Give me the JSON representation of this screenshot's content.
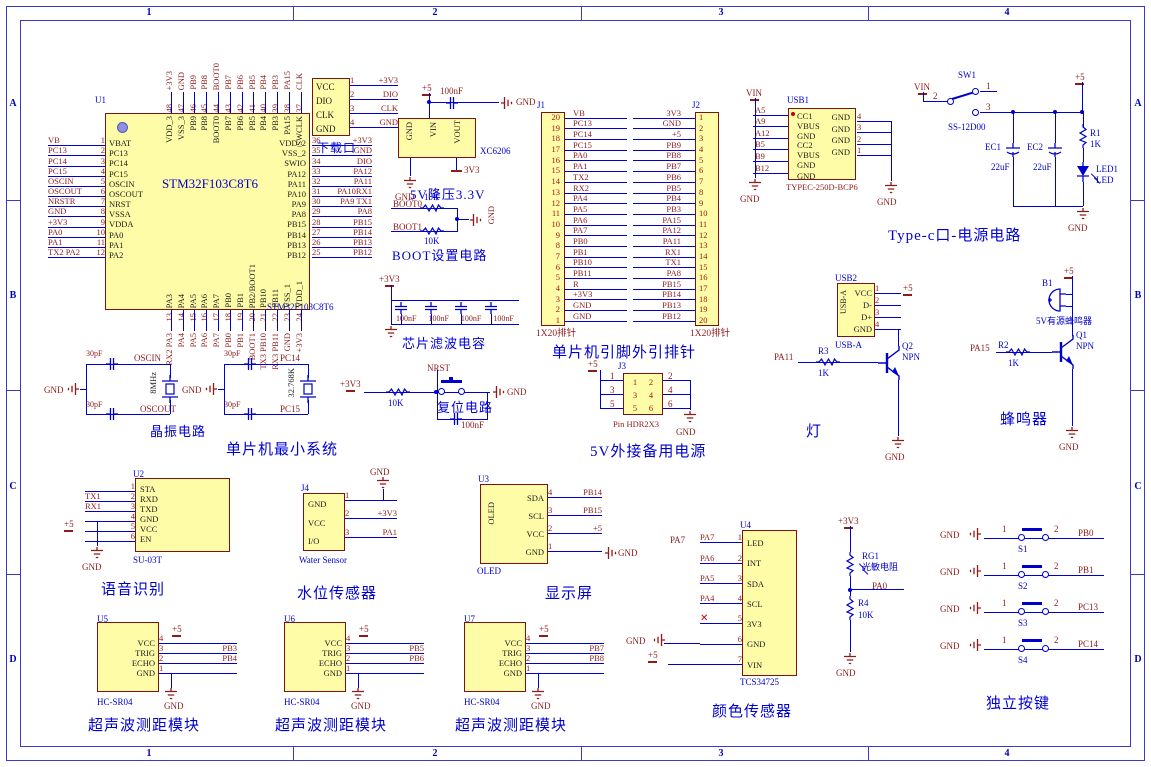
{
  "frame": {
    "cols": [
      "1",
      "2",
      "3",
      "4"
    ],
    "rows": [
      "A",
      "B",
      "C",
      "D"
    ]
  },
  "colors": {
    "wire": "#0000cd",
    "fill": "#fffca8",
    "border": "#7d1414",
    "net": "#8e1a1a"
  },
  "mcu": {
    "ref": "U1",
    "name": "STM32F103C8T6",
    "footer": "STM32F103C8T6",
    "left_pins": [
      {
        "net": "VB",
        "num": "1",
        "name": "VBAT"
      },
      {
        "net": "PC13",
        "num": "2",
        "name": "PC13"
      },
      {
        "net": "PC14",
        "num": "3",
        "name": "PC14"
      },
      {
        "net": "PC15",
        "num": "4",
        "name": "PC15"
      },
      {
        "net": "OSCIN",
        "num": "5",
        "name": "OSCIN"
      },
      {
        "net": "OSCOUT",
        "num": "6",
        "name": "OSCOUT"
      },
      {
        "net": "NRSTR",
        "num": "7",
        "name": "NRST"
      },
      {
        "net": "GND",
        "num": "8",
        "name": "VSSA"
      },
      {
        "net": "+3V3",
        "num": "9",
        "name": "VDDA"
      },
      {
        "net": "PA0",
        "num": "10",
        "name": "PA0"
      },
      {
        "net": "PA1",
        "num": "11",
        "name": "PA1"
      },
      {
        "net": "TX2 PA2",
        "num": "12",
        "name": "PA2"
      }
    ],
    "right_pins": [
      {
        "num": "36",
        "net": "+3V3",
        "name": "VDD_2"
      },
      {
        "num": "35",
        "net": "GND",
        "name": "VSS_2"
      },
      {
        "num": "34",
        "net": "DIO",
        "name": "SWIO"
      },
      {
        "num": "33",
        "net": "PA12",
        "name": "PA12"
      },
      {
        "num": "32",
        "net": "PA11",
        "name": "PA11"
      },
      {
        "num": "31",
        "net": "PA10RX1",
        "name": "PA10"
      },
      {
        "num": "30",
        "net": "PA9 TX1",
        "name": "PA9"
      },
      {
        "num": "29",
        "net": "PA8",
        "name": "PA8"
      },
      {
        "num": "28",
        "net": "PB15",
        "name": "PB15"
      },
      {
        "num": "27",
        "net": "PB14",
        "name": "PB14"
      },
      {
        "num": "26",
        "net": "PB13",
        "name": "PB13"
      },
      {
        "num": "25",
        "net": "PB12",
        "name": "PB12"
      }
    ],
    "top_pins": [
      {
        "num": "48",
        "net": "+3V3",
        "name": "VDD_3"
      },
      {
        "num": "47",
        "net": "GND",
        "name": "VSS_3"
      },
      {
        "num": "46",
        "net": "PB9",
        "name": "PB9"
      },
      {
        "num": "45",
        "net": "PB8",
        "name": "PB8"
      },
      {
        "num": "44",
        "net": "BOOT0",
        "name": "BOOT0"
      },
      {
        "num": "43",
        "net": "PB7",
        "name": "PB7"
      },
      {
        "num": "42",
        "net": "PB6",
        "name": "PB6"
      },
      {
        "num": "41",
        "net": "PB5",
        "name": "PB5"
      },
      {
        "num": "40",
        "net": "PB4",
        "name": "PB4"
      },
      {
        "num": "39",
        "net": "PB3",
        "name": "PB3"
      },
      {
        "num": "38",
        "net": "PA15",
        "name": "PA15"
      },
      {
        "num": "37",
        "net": "CLK",
        "name": "SWCLK"
      }
    ],
    "bottom_pins": [
      {
        "num": "13",
        "net": "RX2 PA3",
        "name": "PA3"
      },
      {
        "num": "14",
        "net": "PA4",
        "name": "PA4"
      },
      {
        "num": "15",
        "net": "PA5",
        "name": "PA5"
      },
      {
        "num": "16",
        "net": "PA6",
        "name": "PA6"
      },
      {
        "num": "17",
        "net": "PA7",
        "name": "PA7"
      },
      {
        "num": "18",
        "net": "PB0",
        "name": "PB0"
      },
      {
        "num": "19",
        "net": "PB1",
        "name": "PB1"
      },
      {
        "num": "20",
        "net": "BOOT1",
        "name": "PB2/BOOT1"
      },
      {
        "num": "21",
        "net": "TX3 PB10",
        "name": "PB10"
      },
      {
        "num": "22",
        "net": "RX3 PB11",
        "name": "PB11"
      },
      {
        "num": "23",
        "net": "GND",
        "name": "VSS_1"
      },
      {
        "num": "24",
        "net": "+3V3",
        "name": "VDD_1"
      }
    ]
  },
  "download": {
    "caption": "下载口",
    "pins": [
      {
        "name": "VCC",
        "num": "1",
        "net": "+3V3"
      },
      {
        "name": "DIO",
        "num": "2",
        "net": "DIO"
      },
      {
        "name": "CLK",
        "num": "3",
        "net": "CLK"
      },
      {
        "name": "GND",
        "num": "4",
        "net": "GND"
      }
    ]
  },
  "regulator": {
    "part": "XC6206",
    "caption": "5V降压3.3V",
    "pin_gnd": "GND",
    "pin_vin": "VIN",
    "pin_vout": "VOUT",
    "rail_in": "+5",
    "cap": "100nF",
    "gnd_top": "GND",
    "gnd_bottom": "GND",
    "rail_out": "3V3"
  },
  "boot": {
    "caption": "BOOT设置电路",
    "net0": "BOOT0",
    "net1": "BOOT1",
    "r0": "10K",
    "r1": "10K",
    "gnd": "GND"
  },
  "filter": {
    "caption": "芯片滤波电容",
    "rail": "+3V3",
    "caps": [
      "100nF",
      "100nF",
      "100nF",
      "100nF"
    ]
  },
  "headers": {
    "caption": "单片机引脚外引排针",
    "j1": {
      "ref": "J1",
      "part": "1X20排针",
      "pins": [
        {
          "num": "20",
          "net": "VB"
        },
        {
          "num": "19",
          "net": "PC13"
        },
        {
          "num": "18",
          "net": "PC14"
        },
        {
          "num": "17",
          "net": "PC15"
        },
        {
          "num": "16",
          "net": "PA0"
        },
        {
          "num": "15",
          "net": "PA1"
        },
        {
          "num": "14",
          "net": "TX2"
        },
        {
          "num": "13",
          "net": "RX2"
        },
        {
          "num": "12",
          "net": "PA4"
        },
        {
          "num": "11",
          "net": "PA5"
        },
        {
          "num": "10",
          "net": "PA6"
        },
        {
          "num": "9",
          "net": "PA7"
        },
        {
          "num": "8",
          "net": "PB0"
        },
        {
          "num": "7",
          "net": "PB1"
        },
        {
          "num": "6",
          "net": "PB10"
        },
        {
          "num": "5",
          "net": "PB11"
        },
        {
          "num": "4",
          "net": "R"
        },
        {
          "num": "3",
          "net": "+3V3"
        },
        {
          "num": "2",
          "net": "GND"
        },
        {
          "num": "1",
          "net": "GND"
        }
      ]
    },
    "j2": {
      "ref": "J2",
      "part": "1X20排针",
      "pins": [
        {
          "num": "1",
          "net": "3V3"
        },
        {
          "num": "2",
          "net": "GND"
        },
        {
          "num": "3",
          "net": "+5"
        },
        {
          "num": "4",
          "net": "PB9"
        },
        {
          "num": "5",
          "net": "PB8"
        },
        {
          "num": "6",
          "net": "PB7"
        },
        {
          "num": "7",
          "net": "PB6"
        },
        {
          "num": "8",
          "net": "PB5"
        },
        {
          "num": "9",
          "net": "PB4"
        },
        {
          "num": "10",
          "net": "PB3"
        },
        {
          "num": "11",
          "net": "PA15"
        },
        {
          "num": "12",
          "net": "PA12"
        },
        {
          "num": "13",
          "net": "PA11"
        },
        {
          "num": "14",
          "net": "RX1"
        },
        {
          "num": "15",
          "net": "TX1"
        },
        {
          "num": "16",
          "net": "PA8"
        },
        {
          "num": "17",
          "net": "PB15"
        },
        {
          "num": "18",
          "net": "PB14"
        },
        {
          "num": "19",
          "net": "PB13"
        },
        {
          "num": "20",
          "net": "PB12"
        }
      ]
    }
  },
  "usb1": {
    "ref": "USB1",
    "part": "TYPEC-250D-BCP6",
    "vin": "VIN",
    "gnd_left": "GND",
    "gnd_right": "GND",
    "extra_name": "GND",
    "left_rows": [
      {
        "net": "A5",
        "name": "CC1"
      },
      {
        "net": "A9",
        "name": "VBUS"
      },
      {
        "net": "A12",
        "name": "GND"
      },
      {
        "net": "B5",
        "name": "CC2"
      },
      {
        "net": "B9",
        "name": "VBUS"
      },
      {
        "net": "B12",
        "name": "GND"
      }
    ],
    "right_rows": [
      {
        "name": "GND",
        "num": "4"
      },
      {
        "name": "GND",
        "num": "3"
      },
      {
        "name": "GND",
        "num": "2"
      },
      {
        "name": "GND",
        "num": "1"
      }
    ]
  },
  "power": {
    "caption": "Type-c口-电源电路",
    "vin": "VIN",
    "sw": "SW1",
    "sw_part": "SS-12D00",
    "p1": "1",
    "p2": "2",
    "p3": "3",
    "rail": "+5",
    "ec1": "EC1",
    "ec1v": "22uF",
    "ec2": "EC2",
    "ec2v": "22uF",
    "r": "R1",
    "rv": "1K",
    "led": "LED1",
    "ledv": "LED",
    "gnd": "GND"
  },
  "xtal": {
    "caption": "晶振电路",
    "sys": "单片机最小系统",
    "x1": {
      "ct": "30pF",
      "cb": "30pF",
      "freq": "8MHz",
      "nt": "OSCIN",
      "nb": "OSCOUT",
      "gnd": "GND"
    },
    "x2": {
      "ct": "30pF",
      "cb": "30pF",
      "freq": "32.768K",
      "nt": "PC14",
      "nb": "PC15",
      "gnd": "GND"
    }
  },
  "reset": {
    "caption": "复位电路",
    "rail": "+3V3",
    "r": "10K",
    "net": "NRST",
    "cap": "100nF",
    "gnd": "GND"
  },
  "j3": {
    "ref": "J3",
    "part": "Pin HDR2X3",
    "caption": "5V外接备用电源",
    "rail": "+5",
    "gnd": "GND",
    "cells": [
      "1",
      "2",
      "3",
      "4",
      "5",
      "6"
    ],
    "l": [
      "1",
      "3",
      "5"
    ],
    "rn": [
      "2",
      "4",
      "6"
    ]
  },
  "lamp": {
    "caption": "灯",
    "ref": "USB2",
    "part": "USB-A",
    "vert": "USB-A",
    "rail": "+5",
    "q": "Q2",
    "qt": "NPN",
    "r": "R3",
    "rv": "1K",
    "net": "PA11",
    "gnd": "GND",
    "pins": [
      {
        "name": "VCC",
        "num": "1"
      },
      {
        "name": "D-",
        "num": "2"
      },
      {
        "name": "D+",
        "num": "3"
      },
      {
        "name": "GND",
        "num": "4"
      }
    ]
  },
  "buzzer": {
    "caption": "蜂鸣器",
    "ref": "B1",
    "name": "5V有源蜂鸣器",
    "rail": "+5",
    "q": "Q1",
    "qt": "NPN",
    "r": "R2",
    "rv": "1K",
    "net": "PA15",
    "gnd": "GND"
  },
  "voice": {
    "ref": "U2",
    "part": "SU-03T",
    "caption": "语音识别",
    "rail": "+5",
    "gnd": "GND",
    "pins": [
      {
        "num": "1",
        "name": "STA",
        "net": ""
      },
      {
        "num": "2",
        "name": "RXD",
        "net": "TX1"
      },
      {
        "num": "3",
        "name": "TXD",
        "net": "RX1"
      },
      {
        "num": "4",
        "name": "GND",
        "net": ""
      },
      {
        "num": "5",
        "name": "VCC",
        "net": ""
      },
      {
        "num": "6",
        "name": "EN",
        "net": ""
      }
    ]
  },
  "water": {
    "ref": "J4",
    "part": "Water Sensor",
    "caption": "水位传感器",
    "gnd": "GND",
    "pins": [
      {
        "name": "GND",
        "num": "1",
        "net": ""
      },
      {
        "name": "VCC",
        "num": "2",
        "net": "+3V3"
      },
      {
        "name": "I/O",
        "num": "3",
        "net": "PA1"
      }
    ]
  },
  "oled": {
    "ref": "U3",
    "part": "OLED",
    "vert": "OLED",
    "caption": "显示屏",
    "gnd": "GND",
    "pins": [
      {
        "name": "SDA",
        "num": "4",
        "net": "PB14"
      },
      {
        "name": "SCL",
        "num": "3",
        "net": "PB15"
      },
      {
        "name": "VCC",
        "num": "2",
        "net": "+5"
      },
      {
        "name": "GND",
        "num": "1",
        "net": ""
      }
    ]
  },
  "color": {
    "ref": "U4",
    "part": "TCS34725",
    "caption": "颜色传感器",
    "gnd": "GND",
    "rail": "+5",
    "pins": [
      {
        "num": "1",
        "name": "LED",
        "net": "PA7"
      },
      {
        "num": "2",
        "name": "INT",
        "net": "PA6"
      },
      {
        "num": "3",
        "name": "SDA",
        "net": "PA5"
      },
      {
        "num": "4",
        "name": "SCL",
        "net": "PA4"
      },
      {
        "num": "5",
        "name": "3V3",
        "net": "✕"
      },
      {
        "num": "6",
        "name": "GND",
        "net": ""
      },
      {
        "num": "7",
        "name": "VIN",
        "net": ""
      }
    ]
  },
  "ldr": {
    "rail": "+3V3",
    "ref": "RG1",
    "name": "光敏电阻",
    "out": "PA0",
    "r": "R4",
    "rv": "10K",
    "gnd": "GND"
  },
  "keys": {
    "caption": "独立按键",
    "items": [
      {
        "gnd": "GND",
        "n1": "1",
        "ref": "S1",
        "n2": "2",
        "net": "PB0"
      },
      {
        "gnd": "GND",
        "n1": "1",
        "ref": "S2",
        "n2": "2",
        "net": "PB1"
      },
      {
        "gnd": "GND",
        "n1": "1",
        "ref": "S3",
        "n2": "2",
        "net": "PC13"
      },
      {
        "gnd": "GND",
        "n1": "1",
        "ref": "S4",
        "n2": "2",
        "net": "PC14"
      }
    ]
  },
  "sonar": {
    "m": [
      {
        "ref": "U5",
        "part": "HC-SR04",
        "caption": "超声波测距模块",
        "rail": "+5",
        "gnd": "GND",
        "pins": [
          {
            "name": "VCC",
            "num": "4",
            "net": ""
          },
          {
            "name": "TRIG",
            "num": "3",
            "net": "PB3"
          },
          {
            "name": "ECHO",
            "num": "2",
            "net": "PB4"
          },
          {
            "name": "GND",
            "num": "1",
            "net": ""
          }
        ]
      },
      {
        "ref": "U6",
        "part": "HC-SR04",
        "caption": "超声波测距模块",
        "rail": "+5",
        "gnd": "GND",
        "pins": [
          {
            "name": "VCC",
            "num": "4",
            "net": ""
          },
          {
            "name": "TRIG",
            "num": "3",
            "net": "PB5"
          },
          {
            "name": "ECHO",
            "num": "2",
            "net": "PB6"
          },
          {
            "name": "GND",
            "num": "1",
            "net": ""
          }
        ]
      },
      {
        "ref": "U7",
        "part": "HC-SR04",
        "caption": "超声波测距模块",
        "rail": "+5",
        "gnd": "GND",
        "pins": [
          {
            "name": "VCC",
            "num": "4",
            "net": ""
          },
          {
            "name": "TRIG",
            "num": "3",
            "net": "PB7"
          },
          {
            "name": "ECHO",
            "num": "2",
            "net": "PB8"
          },
          {
            "name": "GND",
            "num": "1",
            "net": ""
          }
        ]
      }
    ]
  }
}
